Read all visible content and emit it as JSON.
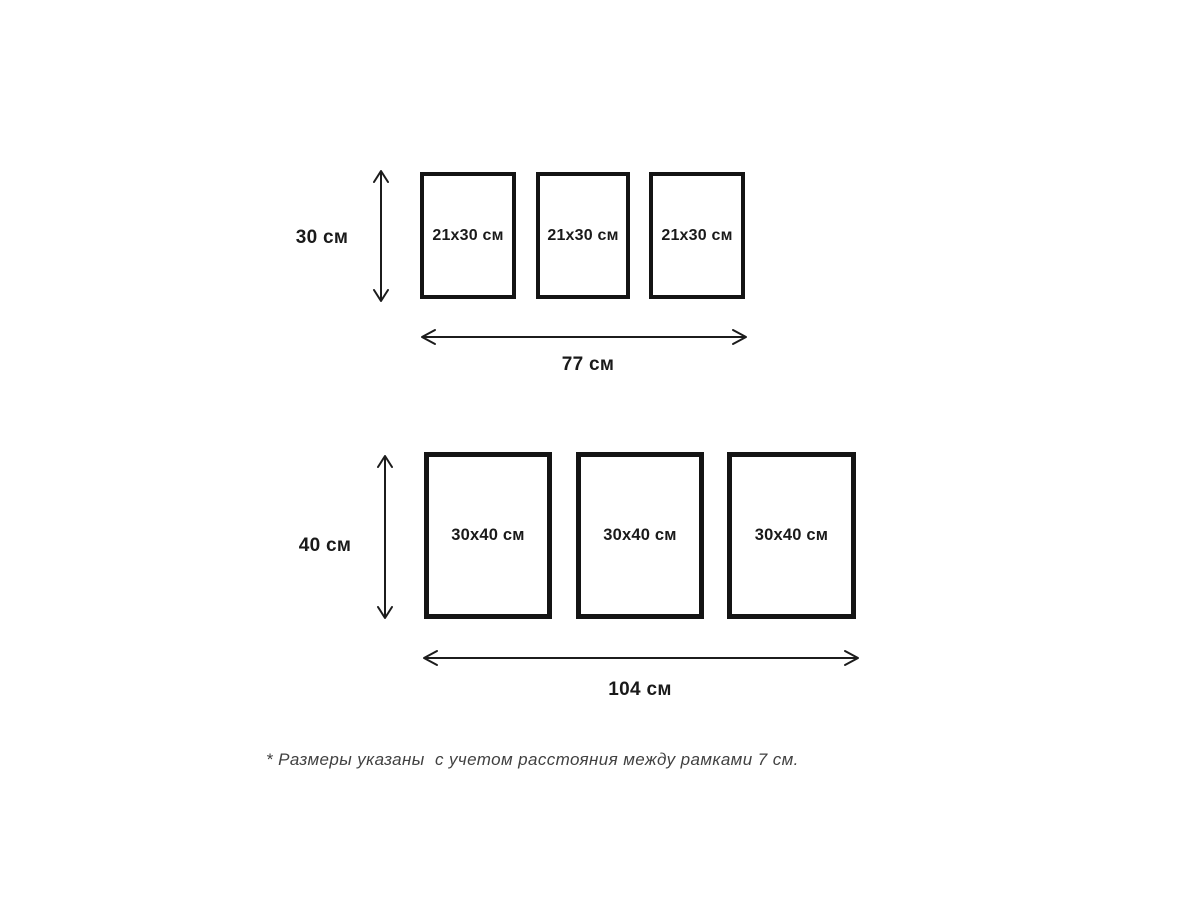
{
  "page": {
    "background": "#ffffff",
    "ink_color": "#141414",
    "footnote_color": "#414141"
  },
  "groups": [
    {
      "name": "set-21x30",
      "height_label": "30 см",
      "width_label": "77 см",
      "frames": [
        {
          "label": "21x30 см"
        },
        {
          "label": "21x30 см"
        },
        {
          "label": "21x30 см"
        }
      ]
    },
    {
      "name": "set-30x40",
      "height_label": "40 см",
      "width_label": "104 см",
      "frames": [
        {
          "label": "30x40 см"
        },
        {
          "label": "30x40 см"
        },
        {
          "label": "30x40 см"
        }
      ]
    }
  ],
  "footnote": "* Размеры указаны  с учетом расстояния между рамками 7 см."
}
